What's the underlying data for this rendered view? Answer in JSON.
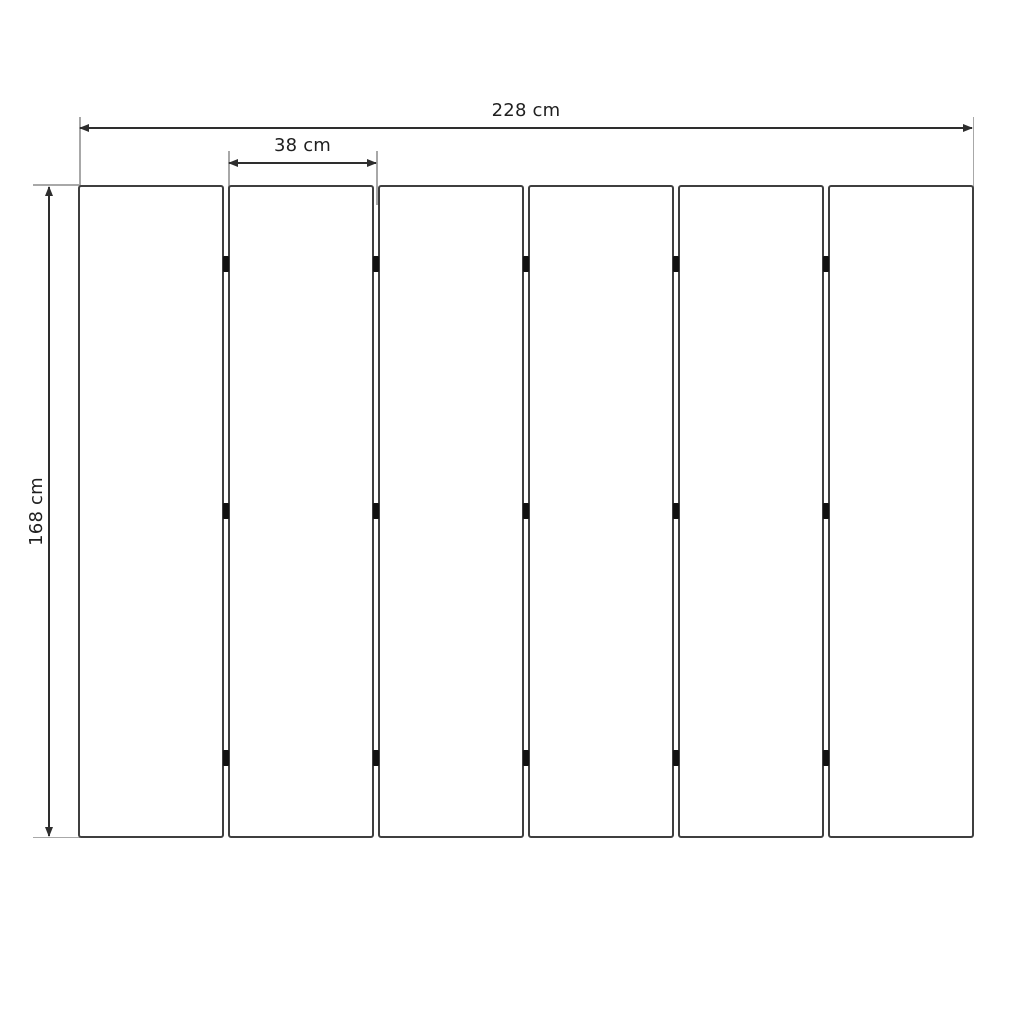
{
  "diagram": {
    "labels": {
      "total_width": "228 cm",
      "panel_width": "38 cm",
      "height": "168 cm"
    },
    "panels": {
      "count": 6,
      "gap_count": 5,
      "hinge_rows_per_gap": 3
    },
    "colors": {
      "background": "#ffffff",
      "panel_border": "#3f3f3f",
      "dimension_line": "#2e2e2e",
      "extension_line": "#a8a8a8",
      "hinge": "#111111",
      "text": "#1f1f1f"
    }
  }
}
